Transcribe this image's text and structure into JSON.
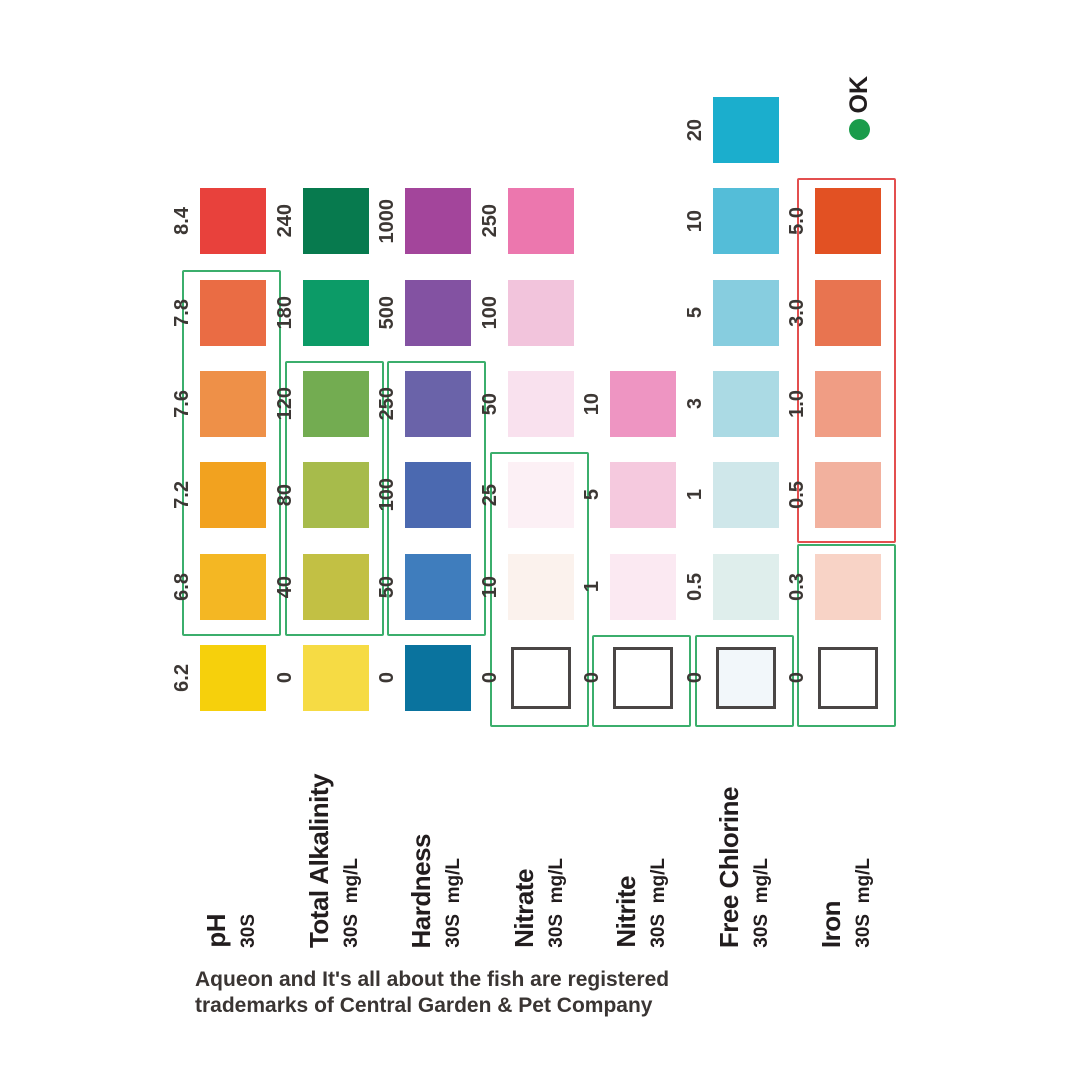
{
  "legend": {
    "ok_label": "OK",
    "dot_color": "#1A9C4B"
  },
  "footer": {
    "line1": "Aqueon and It's all about the fish are registered",
    "line2": "trademarks of Central Garden & Pet Company"
  },
  "chart_data": {
    "type": "table",
    "orientation": "rotated-90-ccw",
    "ok_box_color": "#3BAE6C",
    "warn_box_color": "#E34F4F",
    "outline_color": "#4A4645",
    "rows": [
      {
        "name": "pH",
        "duration": "30S",
        "unit": "",
        "swatches": [
          {
            "value": "8.4",
            "color": "#E8413C"
          },
          {
            "value": "7.8",
            "color": "#EA6C44"
          },
          {
            "value": "7.6",
            "color": "#EE9048"
          },
          {
            "value": "7.2",
            "color": "#F2A21F"
          },
          {
            "value": "6.8",
            "color": "#F4B723"
          },
          {
            "value": "6.2",
            "color": "#F6D00C"
          }
        ],
        "ok_box": {
          "from": "7.8",
          "to": "6.8"
        }
      },
      {
        "name": "Total Alkalinity",
        "duration": "30S",
        "unit": "mg/L",
        "swatches": [
          {
            "value": "240",
            "color": "#077A4E"
          },
          {
            "value": "180",
            "color": "#0C9B67"
          },
          {
            "value": "120",
            "color": "#73AC51"
          },
          {
            "value": "80",
            "color": "#A7BB4B"
          },
          {
            "value": "40",
            "color": "#C2C044"
          },
          {
            "value": "0",
            "color": "#F6DB44"
          }
        ],
        "ok_box": {
          "from": "120",
          "to": "40"
        }
      },
      {
        "name": "Hardness",
        "duration": "30S",
        "unit": "mg/L",
        "swatches": [
          {
            "value": "1000",
            "color": "#A3459B"
          },
          {
            "value": "500",
            "color": "#8352A2"
          },
          {
            "value": "250",
            "color": "#6A63A9"
          },
          {
            "value": "100",
            "color": "#4B69B0"
          },
          {
            "value": "50",
            "color": "#3F7DBD"
          },
          {
            "value": "0",
            "color": "#0A739E"
          }
        ],
        "ok_box": {
          "from": "250",
          "to": "50"
        }
      },
      {
        "name": "Nitrate",
        "duration": "30S",
        "unit": "mg/L",
        "swatches": [
          {
            "value": "250",
            "color": "#EC77AE"
          },
          {
            "value": "100",
            "color": "#F2C4DC"
          },
          {
            "value": "50",
            "color": "#F9E1EE"
          },
          {
            "value": "25",
            "color": "#FCF0F5"
          },
          {
            "value": "10",
            "color": "#FBF2ED"
          },
          {
            "value": "0",
            "color": "#FFFFFF",
            "outlined": true
          }
        ],
        "ok_box": {
          "from": "25",
          "to": "0"
        }
      },
      {
        "name": "Nitrite",
        "duration": "30S",
        "unit": "mg/L",
        "swatches": [
          {
            "value": "10",
            "color": "#EE95C2"
          },
          {
            "value": "5",
            "color": "#F5C9DE"
          },
          {
            "value": "1",
            "color": "#FBE9F2"
          },
          {
            "value": "0",
            "color": "#FFFFFF",
            "outlined": true
          }
        ],
        "ok_box": {
          "from": "0",
          "to": "0"
        }
      },
      {
        "name": "Free Chlorine",
        "duration": "30S",
        "unit": "mg/L",
        "swatches": [
          {
            "value": "20",
            "color": "#1BAECD"
          },
          {
            "value": "10",
            "color": "#54BDD8"
          },
          {
            "value": "5",
            "color": "#87CDDF"
          },
          {
            "value": "3",
            "color": "#ABDAE4"
          },
          {
            "value": "1",
            "color": "#CFE7EA"
          },
          {
            "value": "0.5",
            "color": "#DFEEEC"
          },
          {
            "value": "0",
            "color": "#F2F7FA",
            "outlined": true
          }
        ],
        "ok_box": {
          "from": "0",
          "to": "0"
        }
      },
      {
        "name": "Iron",
        "duration": "30S",
        "unit": "mg/L",
        "swatches": [
          {
            "value": "5.0",
            "color": "#E25123"
          },
          {
            "value": "3.0",
            "color": "#E87450"
          },
          {
            "value": "1.0",
            "color": "#F09D84"
          },
          {
            "value": "0.5",
            "color": "#F2B19E"
          },
          {
            "value": "0.3",
            "color": "#F8D3C6"
          },
          {
            "value": "0",
            "color": "#FFFFFF",
            "outlined": true
          }
        ],
        "ok_box": {
          "from": "0.3",
          "to": "0"
        },
        "warn_box": {
          "from": "5.0",
          "to": "0.5"
        }
      }
    ]
  }
}
